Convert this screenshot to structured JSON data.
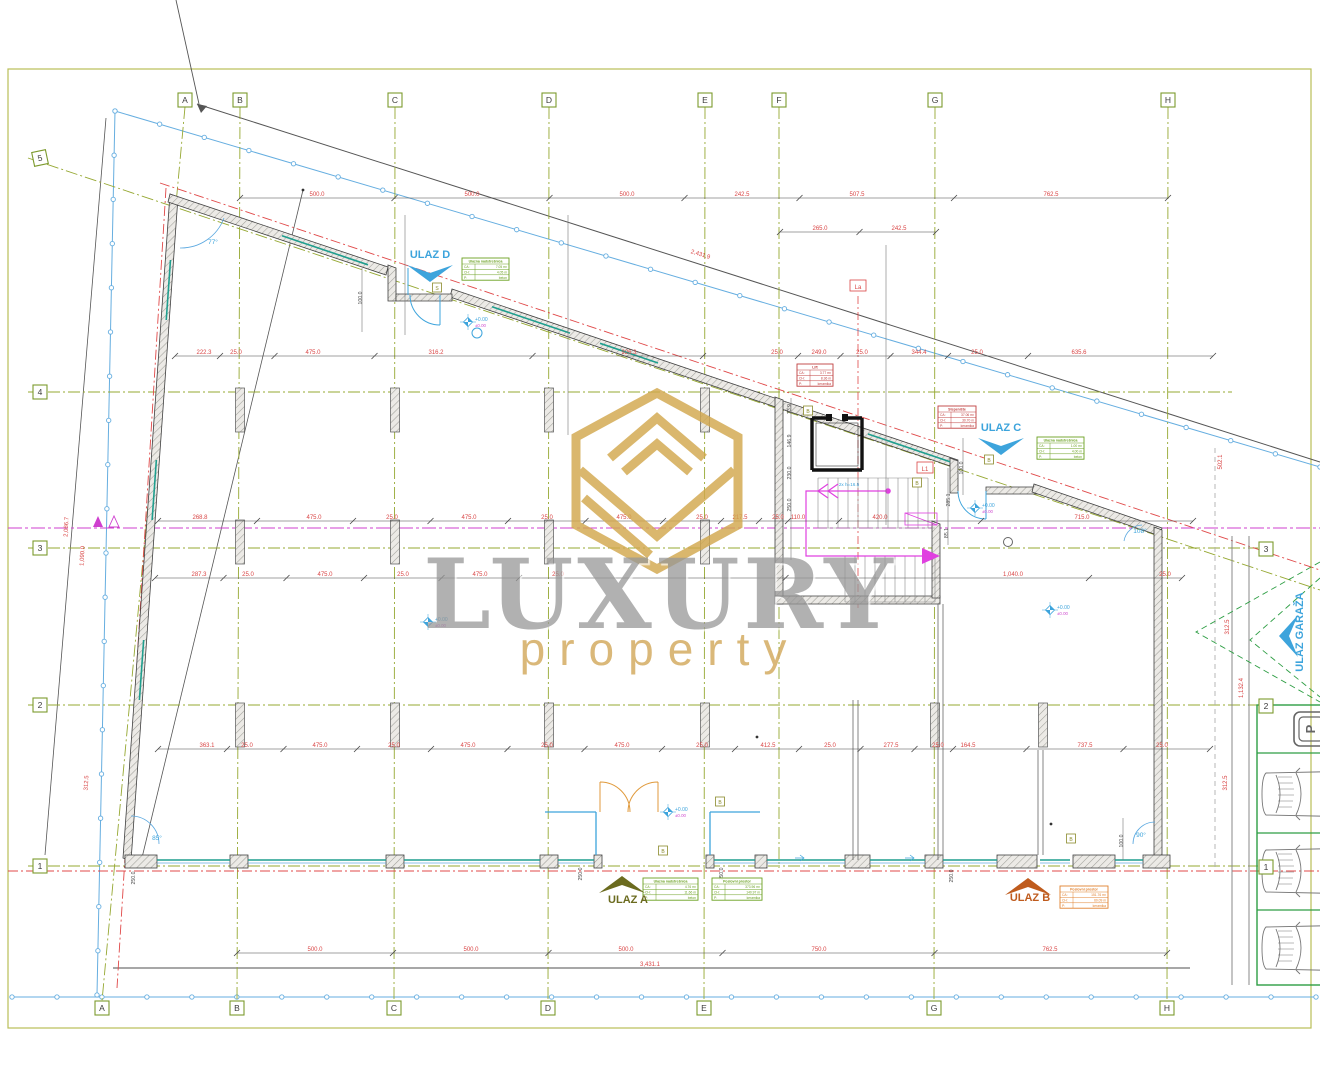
{
  "watermark": {
    "title": "LUXURY",
    "subtitle": "property"
  },
  "grid_markers": {
    "top": [
      {
        "label": "A",
        "x": 185,
        "y": 100
      },
      {
        "label": "B",
        "x": 240,
        "y": 100
      },
      {
        "label": "C",
        "x": 395,
        "y": 100
      },
      {
        "label": "D",
        "x": 549,
        "y": 100
      },
      {
        "label": "E",
        "x": 705,
        "y": 100
      },
      {
        "label": "F",
        "x": 779,
        "y": 100
      },
      {
        "label": "G",
        "x": 935,
        "y": 100
      },
      {
        "label": "H",
        "x": 1168,
        "y": 100
      }
    ],
    "bottom": [
      {
        "label": "A",
        "x": 102,
        "y": 1008
      },
      {
        "label": "B",
        "x": 237,
        "y": 1008
      },
      {
        "label": "C",
        "x": 394,
        "y": 1008
      },
      {
        "label": "D",
        "x": 548,
        "y": 1008
      },
      {
        "label": "E",
        "x": 704,
        "y": 1008
      },
      {
        "label": "G",
        "x": 934,
        "y": 1008
      },
      {
        "label": "H",
        "x": 1167,
        "y": 1008
      }
    ],
    "left": [
      {
        "label": "5",
        "x": 40,
        "y": 158
      },
      {
        "label": "4",
        "x": 40,
        "y": 392
      },
      {
        "label": "3",
        "x": 40,
        "y": 548
      },
      {
        "label": "2",
        "x": 40,
        "y": 705
      },
      {
        "label": "1",
        "x": 40,
        "y": 866
      }
    ],
    "right": [
      {
        "label": "3",
        "x": 1266,
        "y": 549
      },
      {
        "label": "2",
        "x": 1266,
        "y": 706
      },
      {
        "label": "1",
        "x": 1266,
        "y": 867
      }
    ]
  },
  "entrances": [
    {
      "id": "ulaz-a",
      "label": "ULAZ A",
      "x": 628,
      "y": 903,
      "color": "#6b6b1f",
      "arrow": "up",
      "ax": 622,
      "ay": 876
    },
    {
      "id": "ulaz-b",
      "label": "ULAZ B",
      "x": 1030,
      "y": 901,
      "color": "#bf5b1d",
      "arrow": "up",
      "ax": 1028,
      "ay": 878
    },
    {
      "id": "ulaz-c",
      "label": "ULAZ C",
      "x": 1001,
      "y": 431,
      "color": "#3da4dc",
      "arrow": "down",
      "ax": 1001,
      "ay": 438
    },
    {
      "id": "ulaz-d",
      "label": "ULAZ D",
      "x": 430,
      "y": 258,
      "color": "#3da4dc",
      "arrow": "down",
      "ax": 430,
      "ay": 265
    },
    {
      "id": "ulaz-garaza",
      "label": "ULAZ GARAŽA",
      "x": 1303,
      "y": 632,
      "color": "#3da4dc",
      "arrow": "left",
      "ax": 1283,
      "ay": 636,
      "rot": -90
    }
  ],
  "dim_rows": [
    {
      "y": 198,
      "x1": 240,
      "x2": 1168,
      "labels": [
        [
          317,
          "500.0"
        ],
        [
          472,
          "500.0"
        ],
        [
          627,
          "500.0"
        ],
        [
          742,
          "242.5"
        ],
        [
          857,
          "507.5"
        ],
        [
          1051,
          "762.5"
        ]
      ]
    },
    {
      "y": 232,
      "x1": 780,
      "x2": 936,
      "labels": [
        [
          820,
          "265.0"
        ],
        [
          899,
          "242.5"
        ]
      ]
    },
    {
      "y": 356,
      "x1": 175,
      "x2": 1213,
      "labels": [
        [
          204,
          "222.3"
        ],
        [
          236,
          "25.0"
        ],
        [
          313,
          "475.0"
        ],
        [
          436,
          "316.2"
        ],
        [
          629,
          "926.3"
        ],
        [
          777,
          "25.0"
        ],
        [
          819,
          "249.0"
        ],
        [
          862,
          "25.0"
        ],
        [
          919,
          "344.4"
        ],
        [
          977,
          "25.0"
        ],
        [
          1079,
          "635.6"
        ]
      ]
    },
    {
      "y": 521,
      "x1": 158,
      "x2": 1193,
      "labels": [
        [
          200,
          "268.8"
        ],
        [
          314,
          "475.0"
        ],
        [
          392,
          "25.0"
        ],
        [
          469,
          "475.0"
        ],
        [
          547,
          "25.0"
        ],
        [
          624,
          "475.0"
        ],
        [
          702,
          "25.0"
        ],
        [
          740,
          "217.5"
        ],
        [
          778,
          "25.0"
        ],
        [
          798,
          "110.0"
        ],
        [
          880,
          "420.0"
        ],
        [
          1082,
          "715.0"
        ]
      ]
    },
    {
      "y": 578,
      "x1": 155,
      "x2": 1182,
      "labels": [
        [
          199,
          "287.3"
        ],
        [
          248,
          "25.0"
        ],
        [
          325,
          "475.0"
        ],
        [
          403,
          "25.0"
        ],
        [
          480,
          "475.0"
        ],
        [
          558,
          "25.0"
        ],
        [
          1013,
          "1,040.0"
        ],
        [
          1165,
          "25.0"
        ]
      ]
    },
    {
      "y": 749,
      "x1": 158,
      "x2": 1210,
      "labels": [
        [
          207,
          "363.1"
        ],
        [
          247,
          "25.0"
        ],
        [
          320,
          "475.0"
        ],
        [
          394,
          "25.0"
        ],
        [
          468,
          "475.0"
        ],
        [
          547,
          "25.0"
        ],
        [
          622,
          "475.0"
        ],
        [
          702,
          "25.0"
        ],
        [
          768,
          "412.5"
        ],
        [
          830,
          "25.0"
        ],
        [
          891,
          "277.5"
        ],
        [
          938,
          "25.0"
        ],
        [
          968,
          "164.5"
        ],
        [
          1085,
          "737.5"
        ],
        [
          1162,
          "25.0"
        ]
      ]
    },
    {
      "y": 953,
      "x1": 237,
      "x2": 1167,
      "labels": [
        [
          315,
          "500.0"
        ],
        [
          471,
          "500.0"
        ],
        [
          626,
          "500.0"
        ],
        [
          819,
          "750.0"
        ],
        [
          1050,
          "762.5"
        ]
      ]
    },
    {
      "y": 968,
      "x1": 113,
      "x2": 1190,
      "total": true,
      "labels": [
        [
          650,
          "3,431.1"
        ]
      ]
    }
  ],
  "labels": [
    {
      "t": "2,431.9",
      "x": 700,
      "y": 256,
      "c": "red",
      "r": 17
    },
    {
      "t": "2,086.7",
      "x": 68,
      "y": 527,
      "c": "red",
      "r": -87
    },
    {
      "t": "1,090.0",
      "x": 84,
      "y": 556,
      "c": "red",
      "r": -87
    },
    {
      "t": "312.5",
      "x": 88,
      "y": 783,
      "c": "red",
      "r": -87
    },
    {
      "t": "502.1",
      "x": 1222,
      "y": 462,
      "c": "red",
      "r": -90
    },
    {
      "t": "312.5",
      "x": 1229,
      "y": 627,
      "c": "red",
      "r": -90
    },
    {
      "t": "1,132.4",
      "x": 1243,
      "y": 688,
      "c": "red",
      "r": -90
    },
    {
      "t": "312.5",
      "x": 1227,
      "y": 783,
      "c": "red",
      "r": -90
    },
    {
      "t": "100.0",
      "x": 362,
      "y": 298,
      "c": "dark",
      "r": -90
    },
    {
      "t": "100.0",
      "x": 963,
      "y": 468,
      "c": "dark",
      "r": -90
    },
    {
      "t": "285.1",
      "x": 950,
      "y": 500,
      "c": "dark",
      "r": -90
    },
    {
      "t": "85.1",
      "x": 948,
      "y": 533,
      "c": "dark",
      "r": -90
    },
    {
      "t": "73.9",
      "x": 791,
      "y": 409,
      "c": "dark",
      "r": -90
    },
    {
      "t": "146.9",
      "x": 791,
      "y": 441,
      "c": "dark",
      "r": -90
    },
    {
      "t": "230.0",
      "x": 791,
      "y": 473,
      "c": "dark",
      "r": -90
    },
    {
      "t": "250.0",
      "x": 791,
      "y": 505,
      "c": "dark",
      "r": -90
    },
    {
      "t": "100.0",
      "x": 1123,
      "y": 841,
      "c": "dark",
      "r": -90
    },
    {
      "t": "250.0",
      "x": 135,
      "y": 878,
      "c": "dark",
      "r": -90
    },
    {
      "t": "250.0",
      "x": 582,
      "y": 874,
      "c": "dark",
      "r": -90
    },
    {
      "t": "250.0",
      "x": 723,
      "y": 874,
      "c": "dark",
      "r": -90
    },
    {
      "t": "250.0",
      "x": 953,
      "y": 876,
      "c": "dark",
      "r": -90
    },
    {
      "t": "77°",
      "x": 213,
      "y": 244,
      "c": "blue"
    },
    {
      "t": "85°",
      "x": 157,
      "y": 840,
      "c": "blue"
    },
    {
      "t": "90°",
      "x": 1141,
      "y": 837,
      "c": "blue"
    },
    {
      "t": "108°",
      "x": 1140,
      "y": 533,
      "c": "blue"
    },
    {
      "t": "2x h=16.5",
      "x": 849,
      "y": 486,
      "c": "bluesm"
    }
  ],
  "boxed_labels": [
    {
      "t": "La",
      "x": 858,
      "y": 288,
      "kind": "red"
    },
    {
      "t": "L1",
      "x": 925,
      "y": 470,
      "kind": "red"
    },
    {
      "t": "S",
      "x": 437,
      "y": 289,
      "kind": "olive"
    },
    {
      "t": "B",
      "x": 808,
      "y": 412,
      "kind": "olive"
    },
    {
      "t": "B",
      "x": 989,
      "y": 461,
      "kind": "olive"
    },
    {
      "t": "B",
      "x": 917,
      "y": 484,
      "kind": "olive"
    },
    {
      "t": "B",
      "x": 663,
      "y": 852,
      "kind": "olive"
    },
    {
      "t": "B",
      "x": 720,
      "y": 803,
      "kind": "olive"
    },
    {
      "t": "B",
      "x": 1071,
      "y": 840,
      "kind": "olive"
    }
  ],
  "elevation_markers": [
    {
      "x": 468,
      "y": 322,
      "top": "+0.00",
      "bottom": "±0.00"
    },
    {
      "x": 428,
      "y": 622,
      "top": "+0.00",
      "bottom": "±0.00"
    },
    {
      "x": 1050,
      "y": 610,
      "top": "+0.00",
      "bottom": "±0.00"
    },
    {
      "x": 668,
      "y": 812,
      "top": "+0.00",
      "bottom": "±0.00"
    },
    {
      "x": 975,
      "y": 508,
      "top": "+0.00",
      "bottom": "±0.00"
    }
  ],
  "tables": [
    {
      "x": 462,
      "y": 258,
      "w": 47,
      "color": "green",
      "title": "Ulazna nadstrešnica",
      "rows": [
        [
          "CA:",
          "7.05 m²"
        ],
        [
          "CH:",
          "4.05 m"
        ],
        [
          "P:",
          "beton"
        ]
      ]
    },
    {
      "x": 797,
      "y": 364,
      "w": 36,
      "color": "red",
      "title": "Lift",
      "rows": [
        [
          "CA:",
          "3.77 m²"
        ],
        [
          "CH:",
          "8.36 m"
        ],
        [
          "P:",
          "keramika"
        ]
      ]
    },
    {
      "x": 938,
      "y": 406,
      "w": 38,
      "color": "red",
      "title": "Stepenište",
      "rows": [
        [
          "CA:",
          "37.06 m²"
        ],
        [
          "CH:",
          "30.70 m"
        ],
        [
          "P:",
          "keramika"
        ]
      ]
    },
    {
      "x": 1037,
      "y": 437,
      "w": 47,
      "color": "green",
      "title": "Ulazna nadstrešnica",
      "rows": [
        [
          "CA:",
          "1.00 m²"
        ],
        [
          "CH:",
          "4.00 m"
        ],
        [
          "P:",
          "beton"
        ]
      ]
    },
    {
      "x": 643,
      "y": 878,
      "w": 55,
      "color": "green",
      "title": "Ulazna nadstrešnica",
      "rows": [
        [
          "CA:",
          "4.76 m²"
        ],
        [
          "CH:",
          "11.66 m"
        ],
        [
          "P:",
          "beton"
        ]
      ]
    },
    {
      "x": 712,
      "y": 878,
      "w": 50,
      "color": "green",
      "title": "Poslovni prostor",
      "rows": [
        [
          "CA:",
          "373.96 m²"
        ],
        [
          "CH:",
          "140.97 m"
        ],
        [
          "P:",
          "keramika"
        ]
      ]
    },
    {
      "x": 1060,
      "y": 886,
      "w": 48,
      "color": "orange",
      "title": "Poslovni prostor",
      "rows": [
        [
          "CA:",
          "151.76 m²"
        ],
        [
          "CH:",
          "60.09 m"
        ],
        [
          "P:",
          "keramika"
        ]
      ]
    }
  ],
  "parking": {
    "sign": "P"
  },
  "colors": {
    "grid_green": "#96a832",
    "frame": "#b9bf57",
    "dim_red": "#d94545",
    "magenta": "#cf3fcf",
    "boundary_blue": "#66aee0",
    "glazing_teal": "#1f9e8e",
    "entrance_blue": "#3da4dc",
    "entrance_olive": "#6b6b1f",
    "entrance_orange": "#bf5b1d",
    "watermark_gold": "#d2a84e",
    "parking_green": "#2e9e44"
  }
}
